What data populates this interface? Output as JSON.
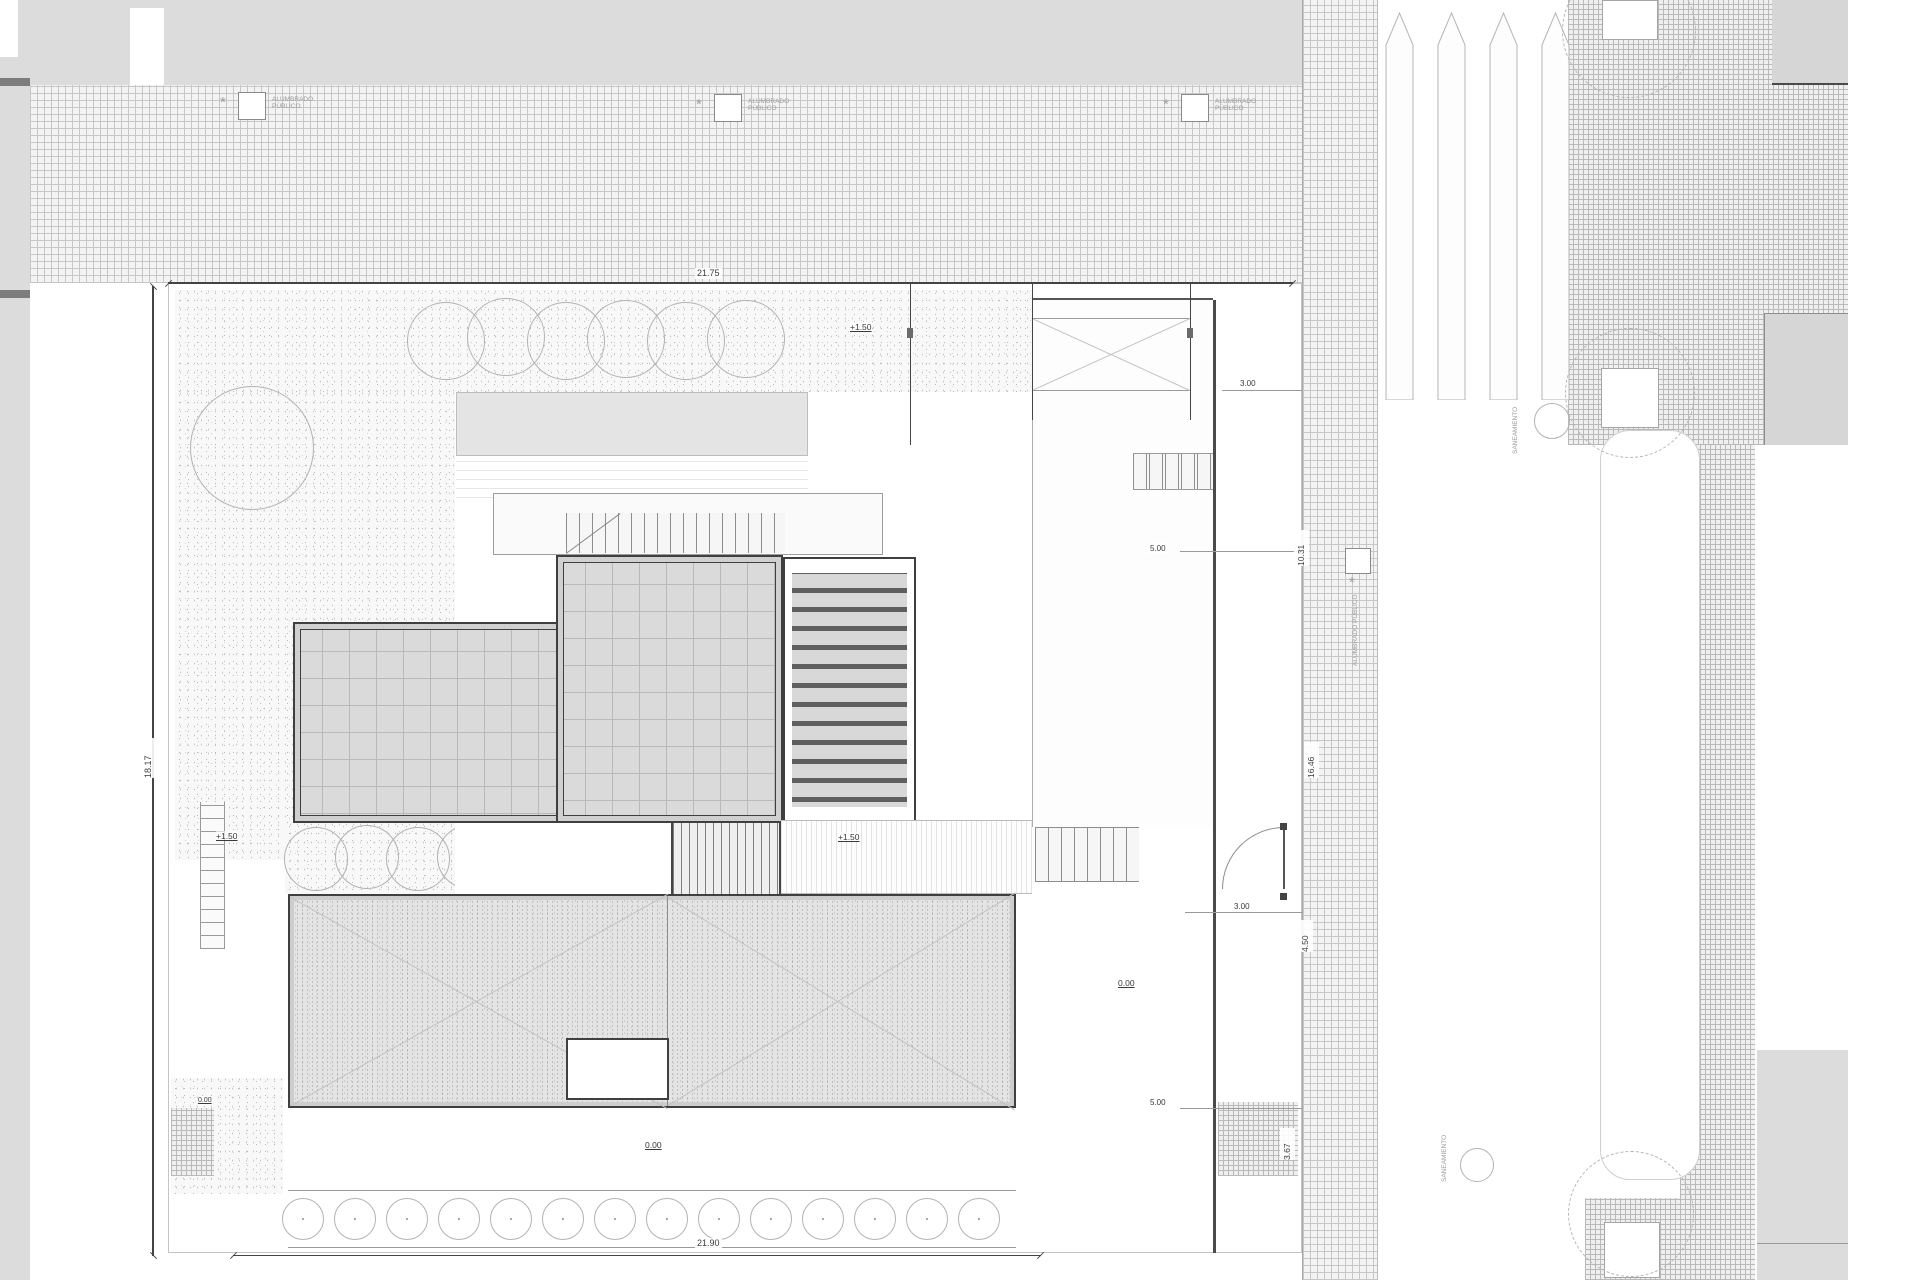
{
  "labels": {
    "street_light": "ALUMBRADO PÚBLICO",
    "sewer": "SANEAMIENTO"
  },
  "dimensions": {
    "top": "21.75",
    "bottom": "21.90",
    "left": "18.17",
    "right_v1": "10.31",
    "right_v2": "16.46",
    "right_v3": "4.50",
    "right_v4": "3.67",
    "h_small_300": "3.00",
    "h_small_500": "5.00"
  },
  "levels": {
    "upper": "+1.50",
    "ground": "0.00"
  }
}
